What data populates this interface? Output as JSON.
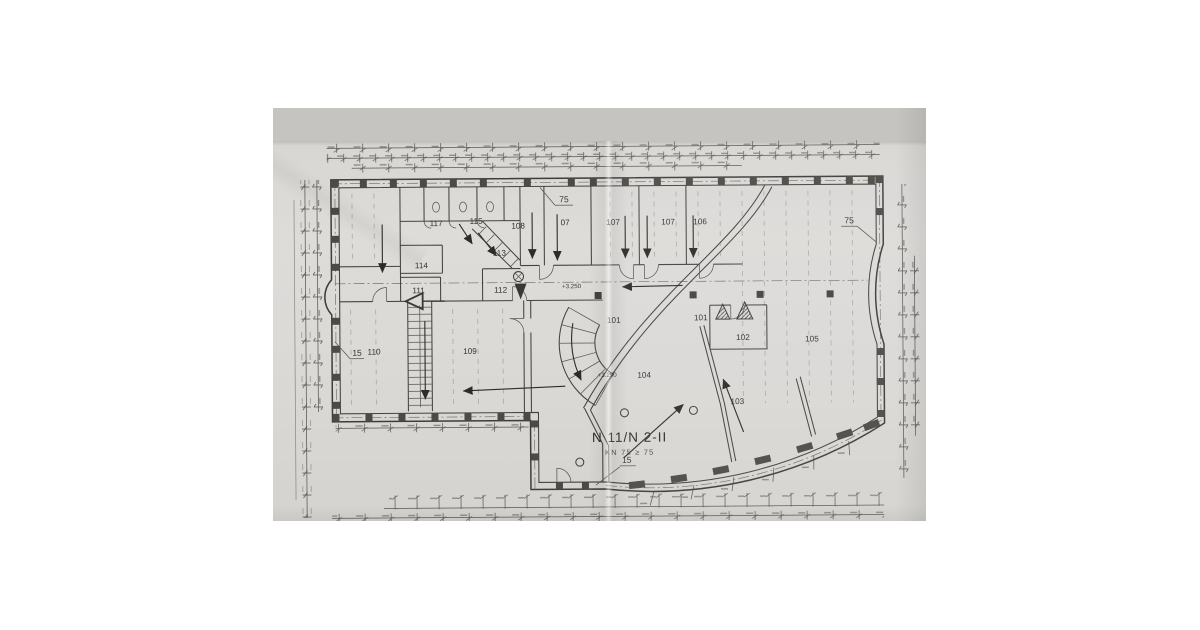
{
  "colors": {
    "page_background": "#ffffff",
    "photo_backdrop": "#c6c4c1",
    "paper": "#dbd9d6",
    "ink": "#3a3835"
  },
  "plan": {
    "title": "N 11/N 2-II",
    "subtitle": "KN 75 ≥ 75",
    "rooms": {
      "r117": "117",
      "r115": "115",
      "r113": "113",
      "r114": "114",
      "r111": "111",
      "r112": "112",
      "r108": "108",
      "r07": "07",
      "r107a": "107",
      "r107b": "107",
      "r106": "106",
      "r101a": "101",
      "r101b": "101",
      "r102": "102",
      "r103": "103",
      "r104": "104",
      "r105": "105",
      "r109": "109",
      "r110": "110"
    },
    "elevations": {
      "e1": "+3.250",
      "e2": "+3.250"
    },
    "notes": {
      "top": "75",
      "right": "75",
      "left": "15",
      "bottom": "15"
    }
  }
}
